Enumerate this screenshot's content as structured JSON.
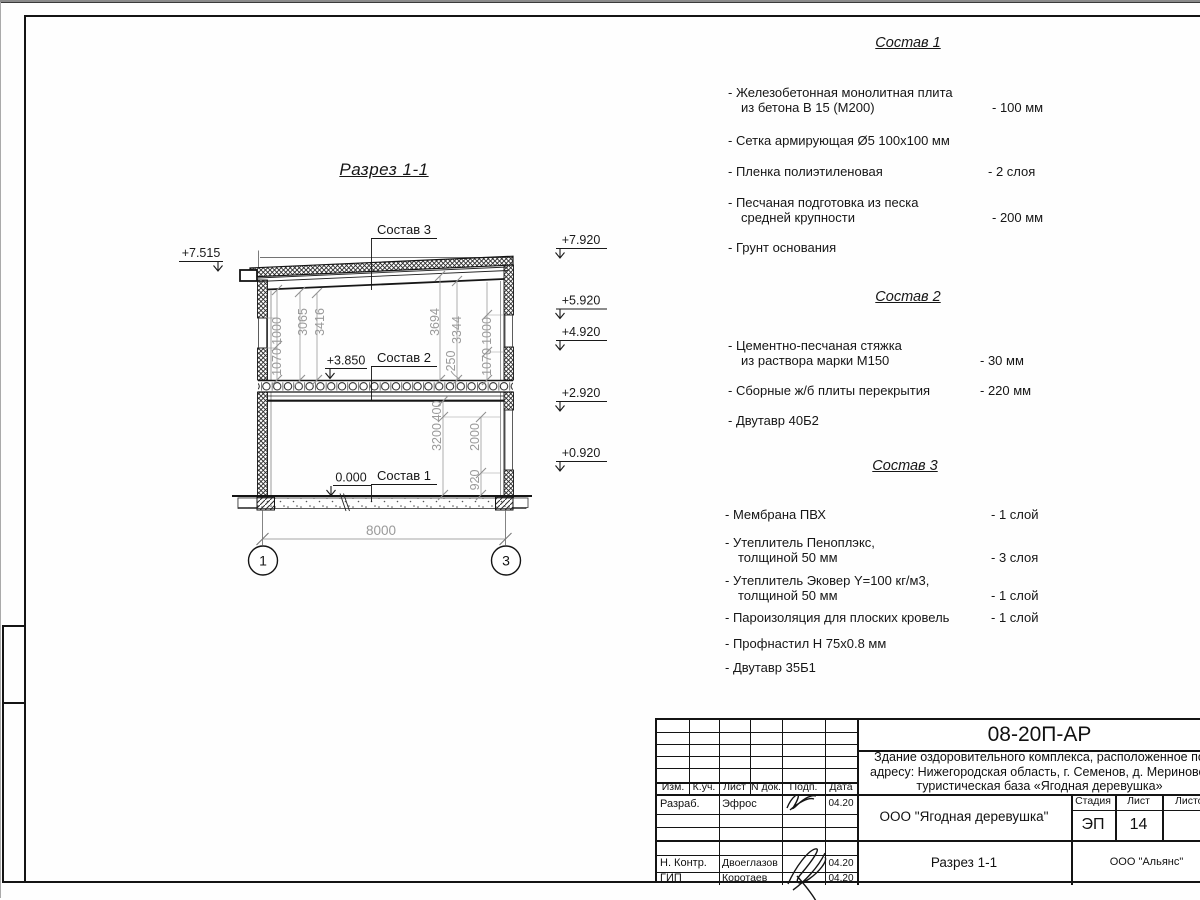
{
  "section": {
    "title": "Разрез 1-1",
    "labels": {
      "comp3": "Состав 3",
      "comp2": "Состав 2",
      "comp1": "Состав 1"
    },
    "elev_left": "+7.515",
    "elev_right": [
      "+7.920",
      "+5.920",
      "+4.920",
      "+2.920",
      "+0.920"
    ],
    "elev_mid": "+3.850",
    "elev_zero": "0.000",
    "dims": {
      "d1000l": "1000",
      "d1070l": "1070",
      "d3065": "3065",
      "d3416": "3416",
      "d3694": "3694",
      "d3344": "3344",
      "d250": "250",
      "d1000r": "1000",
      "d1070r": "1070",
      "d400": "400",
      "d3200": "3200",
      "d2000": "2000",
      "d920": "920",
      "d8000": "8000"
    },
    "axis1": "1",
    "axis3": "3"
  },
  "comp1": {
    "title": "Состав 1",
    "items": [
      {
        "l1": "- Железобетонная  монолитная плита",
        "l2": "из бетона В 15 (М200)",
        "v": "- 100 мм"
      },
      {
        "l1": "- Сетка армирующая Ø5 100х100 мм",
        "l2": "",
        "v": ""
      },
      {
        "l1": "- Пленка полиэтиленовая",
        "l2": "",
        "v": "-  2 слоя"
      },
      {
        "l1": "- Песчаная подготовка из песка",
        "l2": "средней крупности",
        "v": "- 200 мм"
      },
      {
        "l1": "- Грунт основания",
        "l2": "",
        "v": ""
      }
    ]
  },
  "comp2": {
    "title": "Состав 2",
    "items": [
      {
        "l1": "- Цементно-песчаная стяжка",
        "l2": "из раствора марки М150",
        "v": "- 30 мм"
      },
      {
        "l1": "- Сборные ж/б плиты перекрытия",
        "l2": "",
        "v": "- 220 мм"
      },
      {
        "l1": "- Двутавр 40Б2",
        "l2": "",
        "v": ""
      }
    ]
  },
  "comp3": {
    "title": "Состав 3",
    "items": [
      {
        "l1": "- Мембрана ПВХ",
        "l2": "",
        "v": "- 1 слой"
      },
      {
        "l1": "- Утеплитель Пеноплэкс,",
        "l2": "толщиной 50 мм",
        "v": "- 3 слоя"
      },
      {
        "l1": "- Утеплитель Эковер Y=100 кг/м3,",
        "l2": "толщиной 50 мм",
        "v": "- 1 слой"
      },
      {
        "l1": "- Пароизоляция для плоских кровель",
        "l2": "",
        "v": "- 1 слой"
      },
      {
        "l1": "- Профнастил Н 75х0.8 мм",
        "l2": "",
        "v": ""
      },
      {
        "l1": "- Двутавр 35Б1",
        "l2": "",
        "v": ""
      }
    ]
  },
  "titleblock": {
    "code": "08-20П-АР",
    "desc1": "Здание оздоровительного комплекса, расположенное по",
    "desc2": "адресу: Нижегородская область, г. Семенов, д. Мериново,",
    "desc3": "туристическая база «Ягодная деревушка»",
    "org": "ООО \"Ягодная деревушка\"",
    "stage_label": "Стадия",
    "sheet_label": "Лист",
    "sheets_label": "Листов",
    "stage": "ЭП",
    "sheet": "14",
    "sheet_title": "Разрез 1-1",
    "contractor": "ООО \"Альянс\"",
    "cols": {
      "izm": "Изм.",
      "kuch": "К.уч.",
      "list": "Лист",
      "ndok": "N док.",
      "podp": "Подп.",
      "data": "Дата"
    },
    "rows": [
      {
        "role": "Разраб.",
        "name": "Эфрос",
        "date": "04.20"
      },
      {
        "role": "Н. Контр.",
        "name": "Двоеглазов",
        "date": "04.20"
      },
      {
        "role": "ГИП",
        "name": "Коротаев",
        "date": "04.20"
      }
    ]
  }
}
